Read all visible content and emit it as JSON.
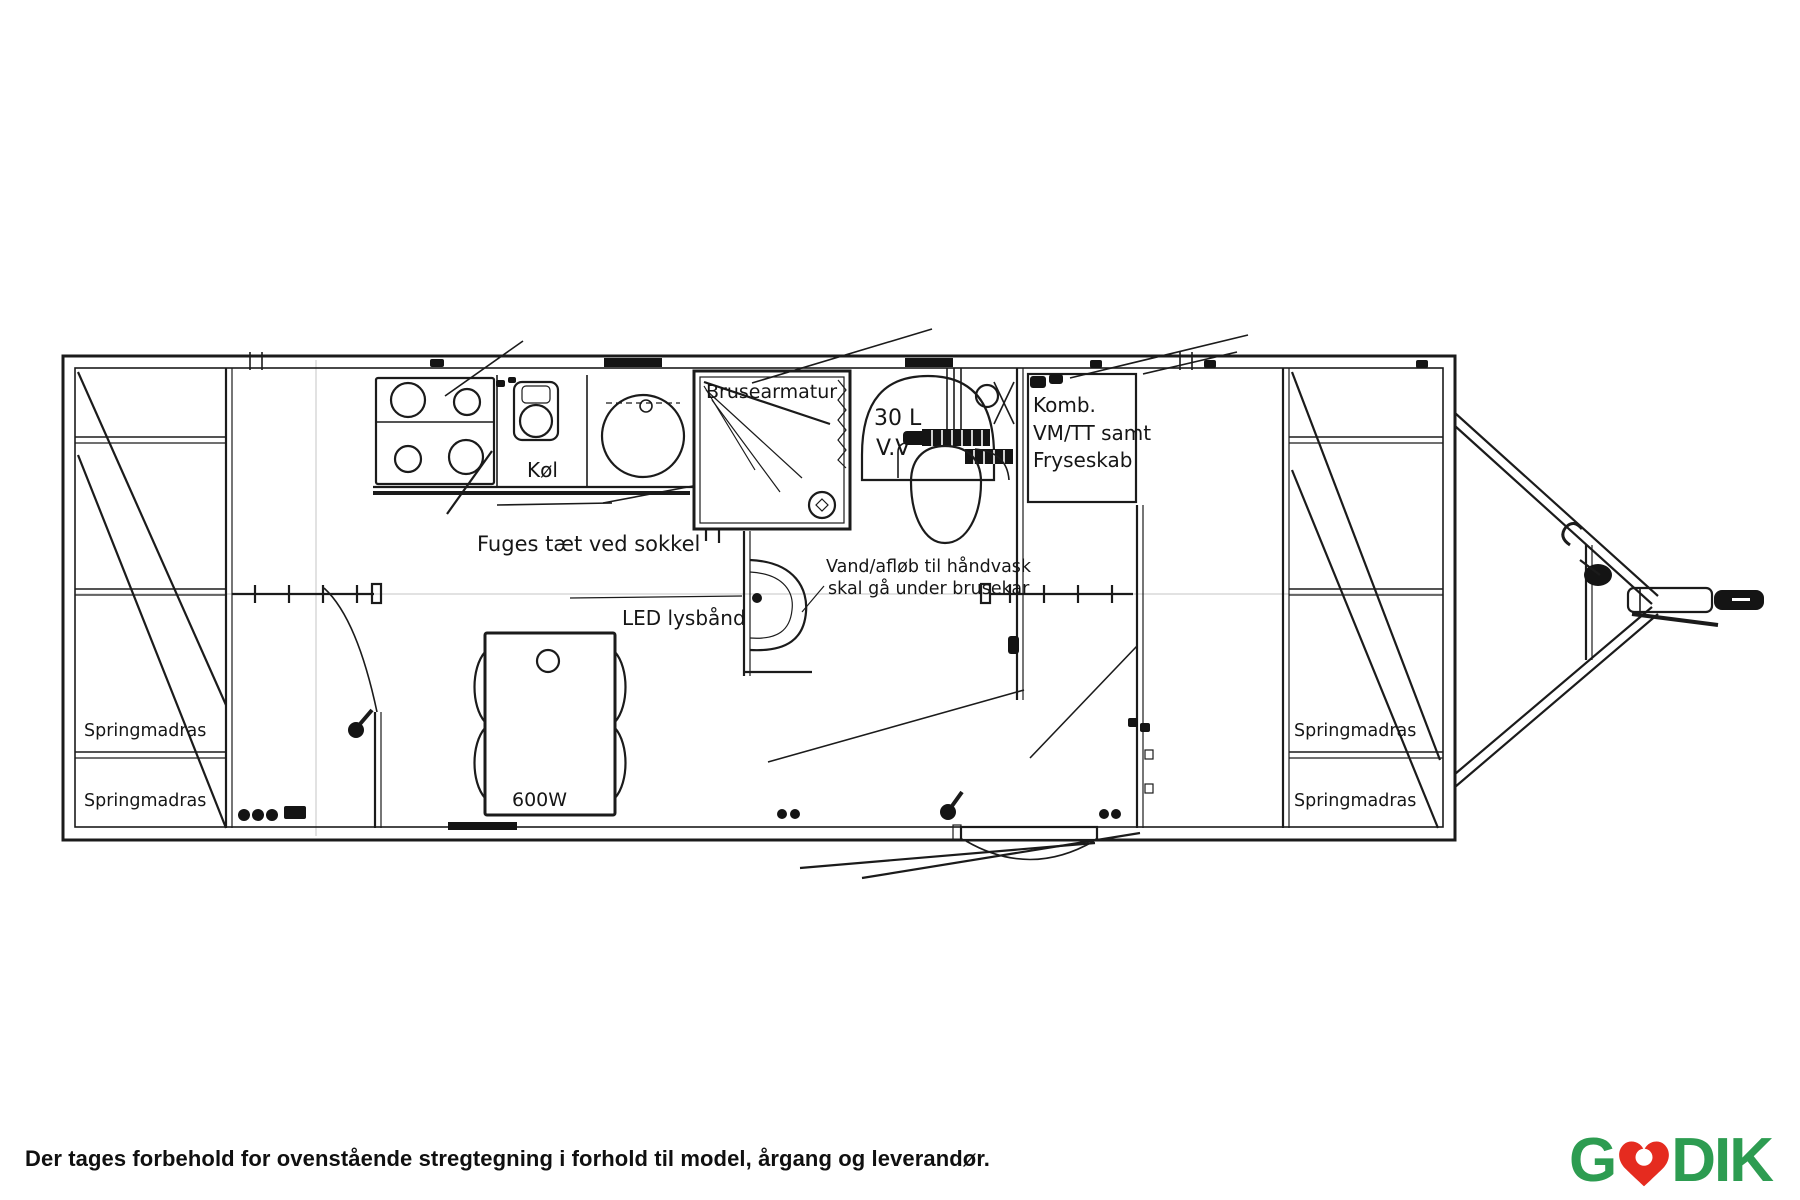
{
  "plan": {
    "kind": "caravan-floor-plan-line-drawing",
    "labels": {
      "shower_fixture": "Brusearmatur",
      "water_heater_volume": "30 L",
      "water_heater_type": "V.V",
      "combi_1": "Komb.",
      "combi_2": "VM/TT samt",
      "combi_3": "Fryseskab",
      "fridge": "Køl",
      "seal_note": "Fuges tæt ved sokkel",
      "led_strip": "LED lysbånd",
      "drain_note_1": "Vand/afløb til håndvask",
      "drain_note_2": "skal gå under brusekar",
      "table_heater": "600W"
    },
    "bunks": [
      {
        "label": "Springmadras"
      },
      {
        "label": "Springmadras"
      },
      {
        "label": "Springmadras"
      },
      {
        "label": "Springmadras"
      }
    ]
  },
  "footer": {
    "disclaimer": "Der tages forbehold for ovenstående stregtegning i forhold til model, årgang og leverandør."
  },
  "logo": {
    "brand": "GODIK",
    "left": "G",
    "right": "DIK",
    "green": "#2D9C51",
    "red": "#E52B1F"
  },
  "colors": {
    "drawing_line": "#1b1b1b",
    "background": "#ffffff"
  }
}
